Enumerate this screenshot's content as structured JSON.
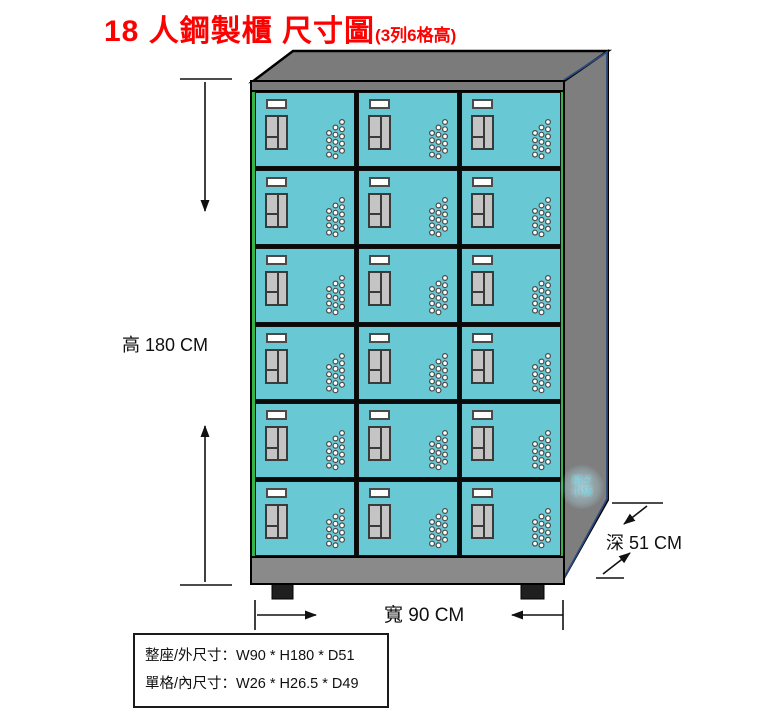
{
  "title": {
    "main": "18 人鋼製櫃 尺寸圖",
    "sub": "(3列6格高)"
  },
  "dimensions": {
    "height_label": "高 180 CM",
    "width_label": "寬 90 CM",
    "depth_label": "深 51 CM"
  },
  "spec_box": {
    "line1": "整座/外尺寸：W90 * H180 * D51",
    "line2": "單格/內尺寸：W26 * H26.5 * D49"
  },
  "locker": {
    "rows": 6,
    "columns": 3,
    "total_compartments": 18
  },
  "watermark": {
    "line1": "櫃子",
    "line2": "小舖"
  },
  "colors": {
    "title_red": "#fe0000",
    "door_teal": "#68c9d5",
    "frame_green": "#35b44a",
    "cabinet_gray": "#7b7b7b",
    "side_gray": "#7e7e7e",
    "base_gray": "#8a8a8a",
    "handle_gray": "#c4c4c4",
    "edge_navy": "#2b4a7e"
  }
}
